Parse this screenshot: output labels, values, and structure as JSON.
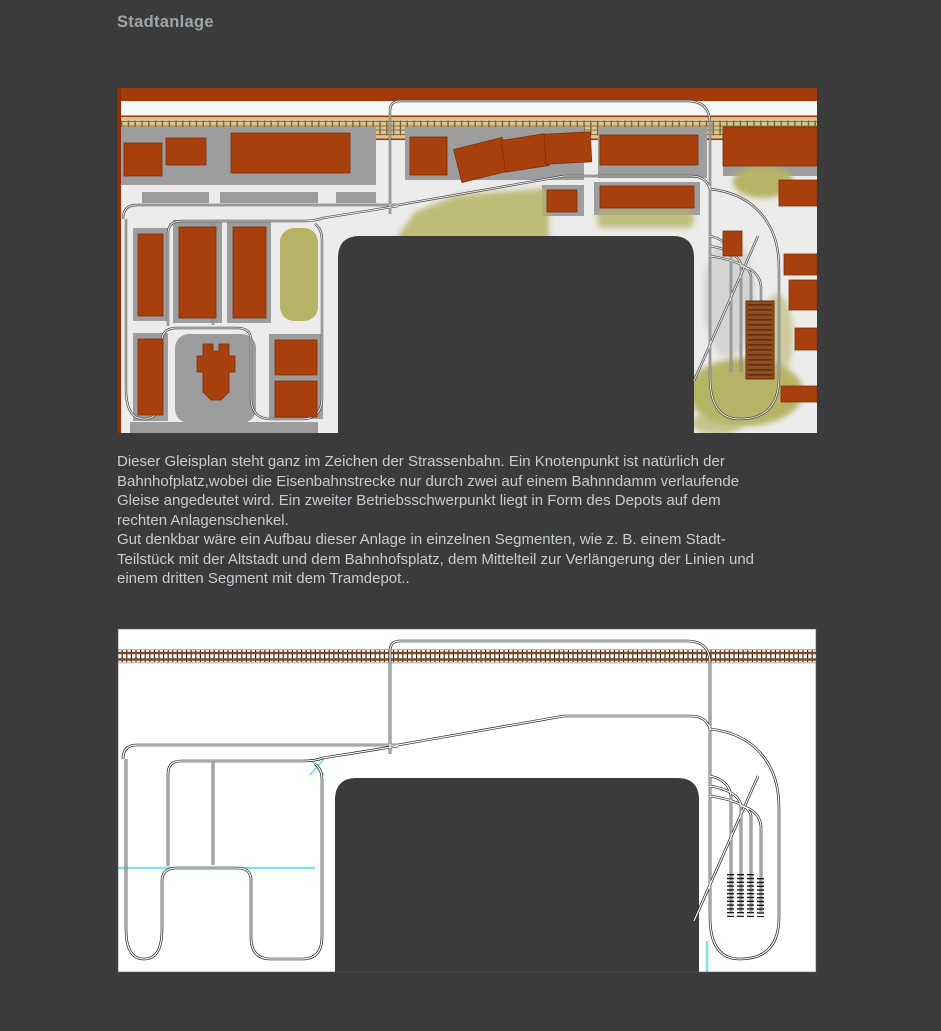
{
  "page": {
    "title": "Stadtanlage"
  },
  "description": "Dieser Gleisplan steht ganz im Zeichen der Strassenbahn. Ein Knotenpunkt ist natürlich der\nBahnhofplatz,wobei die Eisenbahnstrecke nur durch zwei auf einem Bahnndamm verlaufende\nGleise angedeutet wird. Ein zweiter Betriebsschwerpunkt liegt in Form des Depots auf dem\nrechten Anlagenschenkel.\nGut denkbar wäre ein Aufbau dieser Anlage in einzelnen Segmenten, wie z. B. einem Stadt-\nTeilstück mit der Altstadt und dem Bahnhofsplatz, dem Mittelteil zur Verlängerung der Linien und\neinem dritten Segment mit dem Tramdepot..",
  "palette": {
    "page_background": "#3b3b3b",
    "title_text": "#9fa5a9",
    "body_text": "#c6cdd2",
    "plan_background": "#ececec",
    "line_plan_background": "#ffffff",
    "building_brick": "#a8400e",
    "block_gray": "#9d9d9d",
    "grass_olive": "#b7b366",
    "railway_beige": "#d9c693",
    "railway_brown": "#7c4b28",
    "track_line": "#1e1e1e",
    "operator_well": "#3b3b3b",
    "cyan_marker": "#7fe3e3",
    "depot_brown": "#8f4d20"
  }
}
